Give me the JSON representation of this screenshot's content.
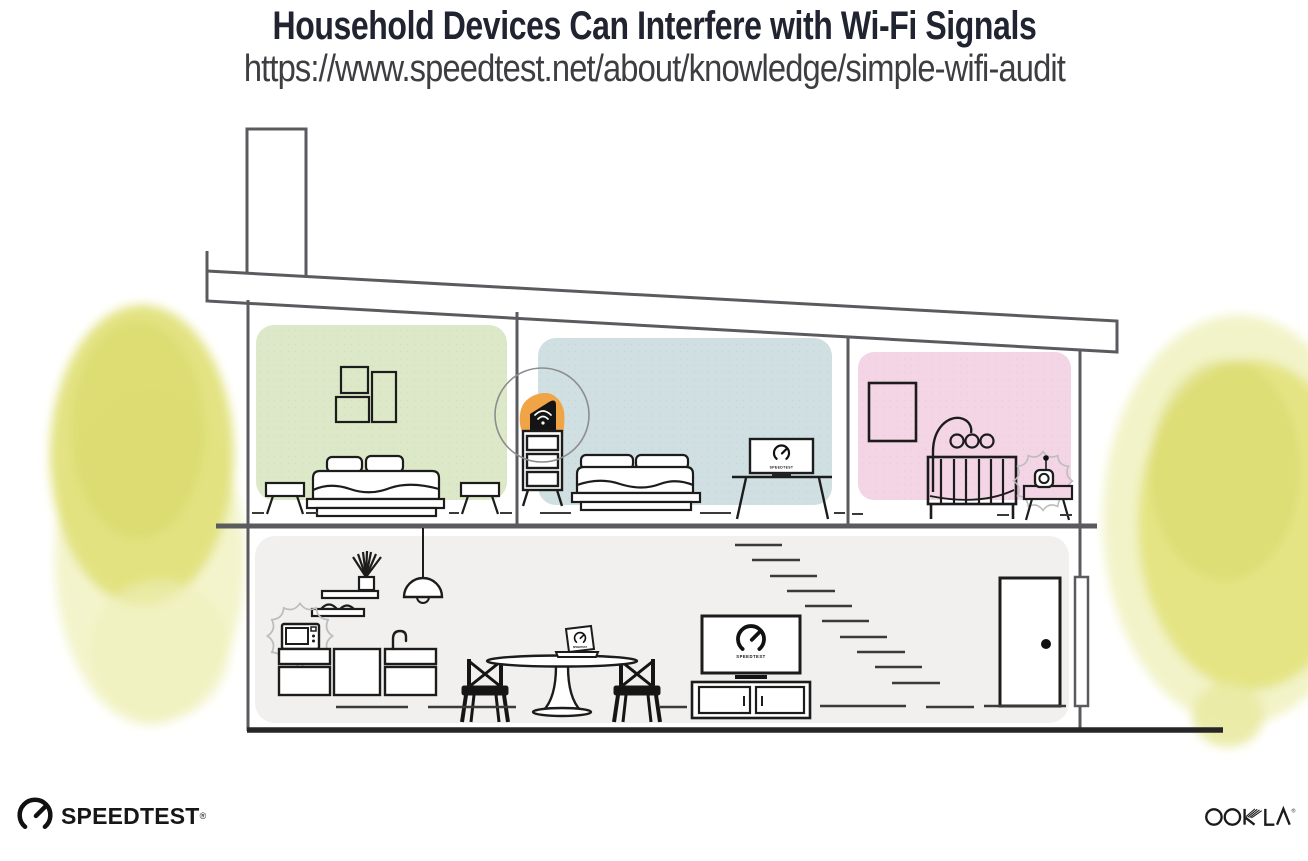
{
  "header": {
    "title": "Household Devices Can Interfere with Wi-Fi Signals",
    "url": "https://www.speedtest.net/about/knowledge/simple-wifi-audit"
  },
  "branding": {
    "speedtest_wordmark": "SPEEDTEST",
    "registered_mark": "®",
    "ookla_wordmark": "OOKLA"
  },
  "illustration": {
    "caption": "Two-story house cross-section: Wi-Fi router on a dresser upstairs, TVs and laptop running Speedtest, microwave and baby monitor emitting interference",
    "screen_label": "SPEEDTEST",
    "colors": {
      "structure_line": "#5b5a5f",
      "ink_line": "#1c1c1c",
      "bedroom_left_wall": "#dce8c7",
      "bedroom_middle_wall": "#cfdfe2",
      "nursery_wall": "#f3d5e5",
      "living_area_wall": "#f1f0ee",
      "router_accent": "#f0a445",
      "foliage": "#e2e27c",
      "foliage_light": "#eff0ba",
      "interference": "#bcbcbc",
      "highlight_ring": "#8d8d8d"
    },
    "rooms": [
      {
        "id": "bedroom-left",
        "label": "bedroom with bed, wall art and side tables"
      },
      {
        "id": "bedroom-middle",
        "label": "bedroom with bed and TV on stand"
      },
      {
        "id": "nursery",
        "label": "nursery with crib, mobile and baby monitor"
      },
      {
        "id": "living-area",
        "label": "living area with kitchen, dining table, TV, stairs and front door"
      }
    ],
    "devices": [
      {
        "id": "wifi-router",
        "highlighted": true
      },
      {
        "id": "microwave",
        "interference": true
      },
      {
        "id": "baby-monitor",
        "interference": true
      },
      {
        "id": "tv-bedroom"
      },
      {
        "id": "tv-living-room"
      },
      {
        "id": "laptop"
      }
    ]
  }
}
